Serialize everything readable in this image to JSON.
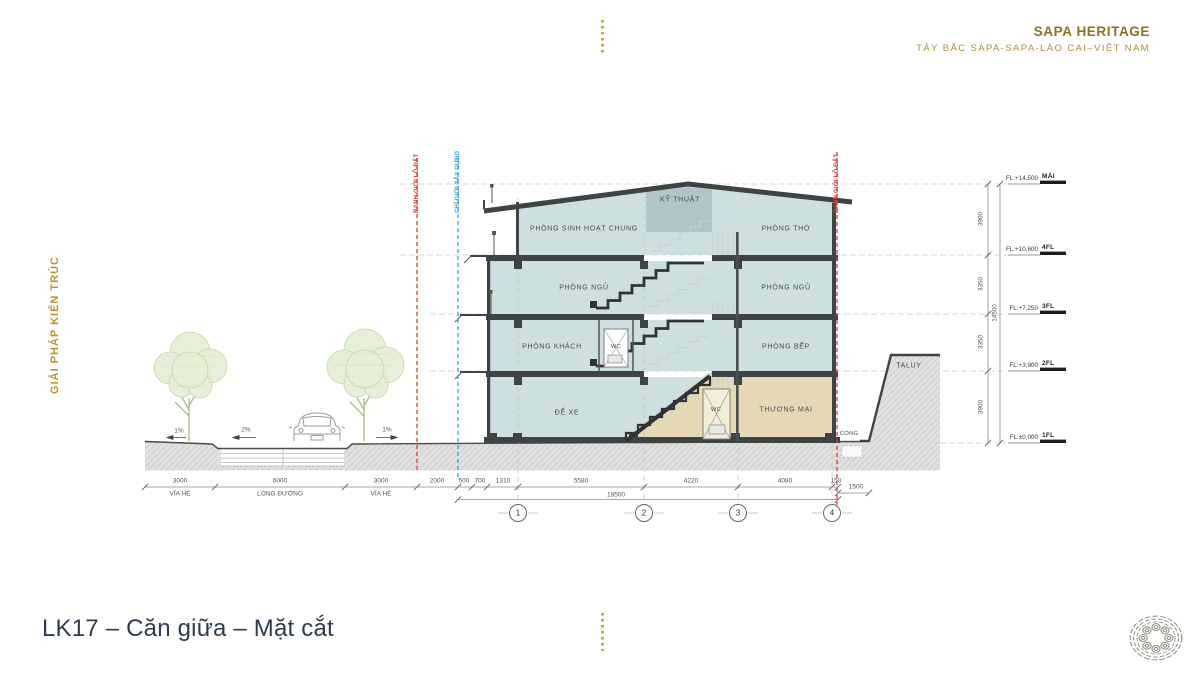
{
  "header": {
    "title": "SAPA HERITAGE",
    "subtitle": "TÂY BẮC SAPA-SAPA-LÀO CAI–VIỆT NAM"
  },
  "side_label": "GIẢI PHÁP KIẾN TRÚC",
  "footer": {
    "title": "LK17 – Căn giữa – Mặt cắt"
  },
  "rooms": {
    "sinh_hoat_chung": "PHÒNG SINH HOẠT CHUNG",
    "ky_thuat": "KỸ THUẬT",
    "phong_tho": "PHÒNG THỜ",
    "ngu_left": "PHÒNG NGỦ",
    "ngu_right": "PHÒNG NGỦ",
    "khach": "PHÒNG KHÁCH",
    "wc_2f": "WC",
    "bep": "PHÒNG BẾP",
    "de_xe": "ĐỂ XE",
    "wc_1f": "WC",
    "thuong_mai": "THƯƠNG MẠI"
  },
  "site": {
    "taluy": "TALUY",
    "cong": "CỔNG",
    "slope_left": "1%",
    "slope_mid": "2%",
    "slope_right": "1%"
  },
  "boundaries": {
    "left_red": "RANH GIỚI LÔ ĐẤT",
    "blue": "CHỈ GIỚI XÂY DỰNG",
    "right_red": "RANH GIỚI LÔ ĐẤT"
  },
  "levels": [
    {
      "fl": "FL:+14,500",
      "tag": "MÁI"
    },
    {
      "fl": "FL:+10,600",
      "tag": "4FL"
    },
    {
      "fl": "FL:+7,250",
      "tag": "3FL"
    },
    {
      "fl": "FL:+3,900",
      "tag": "2FL"
    },
    {
      "fl": "FL:±0,000",
      "tag": "1FL"
    }
  ],
  "vdims": [
    "3900",
    "3350",
    "3350",
    "3900"
  ],
  "vtotal": "14500",
  "site_dims": [
    {
      "v": "3000",
      "l": "VỈA HÈ"
    },
    {
      "v": "6000",
      "l": "LÒNG ĐƯỜNG"
    },
    {
      "v": "3000",
      "l": "VỈA HÈ"
    }
  ],
  "hdims": [
    "2000",
    "500",
    "700",
    "1310",
    "5580",
    "4220",
    "4080",
    "150"
  ],
  "hdim_right": "1500",
  "htotal": "18500",
  "grid": [
    "1",
    "2",
    "3",
    "4"
  ],
  "colors": {
    "accent_gold": "#9c7e2d",
    "boundary_red": "#e03a2f",
    "boundary_blue": "#2aa8de",
    "room_fill": "#cddfde",
    "tech_fill": "#b0c5c8",
    "commercial_fill": "#e5d9b5",
    "structure_dark": "#3e4346",
    "title_navy": "#2e3c4e"
  }
}
